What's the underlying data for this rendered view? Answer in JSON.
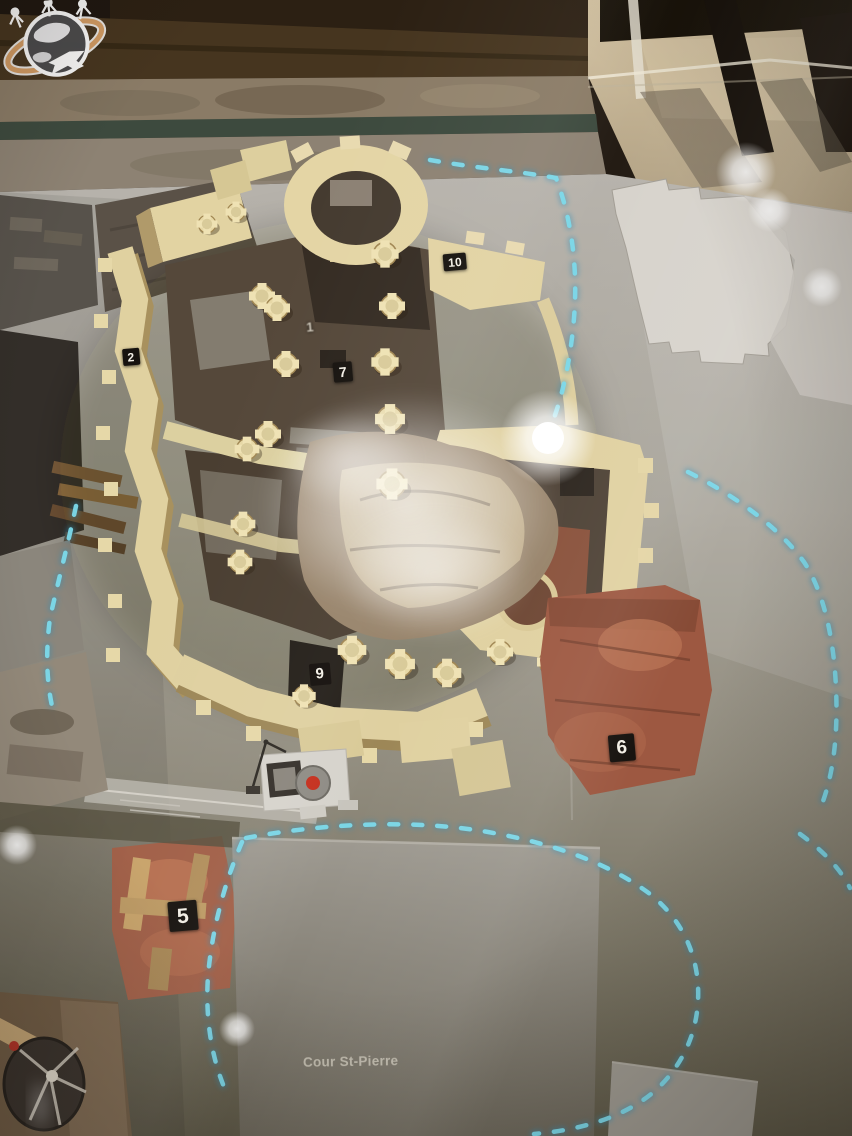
{
  "labels": {
    "courtyard": "Cour St-Pierre"
  },
  "markers": [
    {
      "number": "1",
      "x": 310,
      "y": 327,
      "style": "faint",
      "size": 13
    },
    {
      "number": "2",
      "x": 131,
      "y": 357,
      "style": "plaque",
      "size": 12
    },
    {
      "number": "5",
      "x": 183,
      "y": 916,
      "style": "plaque",
      "size": 21
    },
    {
      "number": "6",
      "x": 622,
      "y": 748,
      "style": "plaque",
      "size": 19
    },
    {
      "number": "7",
      "x": 343,
      "y": 372,
      "style": "plaque",
      "size": 14
    },
    {
      "number": "9",
      "x": 320,
      "y": 674,
      "style": "dark",
      "size": 15
    },
    {
      "number": "10",
      "x": 455,
      "y": 262,
      "style": "plaque",
      "size": 12
    }
  ],
  "colors": {
    "led_accent": "#7cd9ea",
    "plaque_bg": "#17130f",
    "plaque_text": "#f3efe6",
    "model_walls": "#e4d5a5",
    "terracotta": "#9d5841",
    "baseplate": "#a7a399"
  },
  "icons": {
    "watermark": "globe-airplane-travel-logo"
  }
}
